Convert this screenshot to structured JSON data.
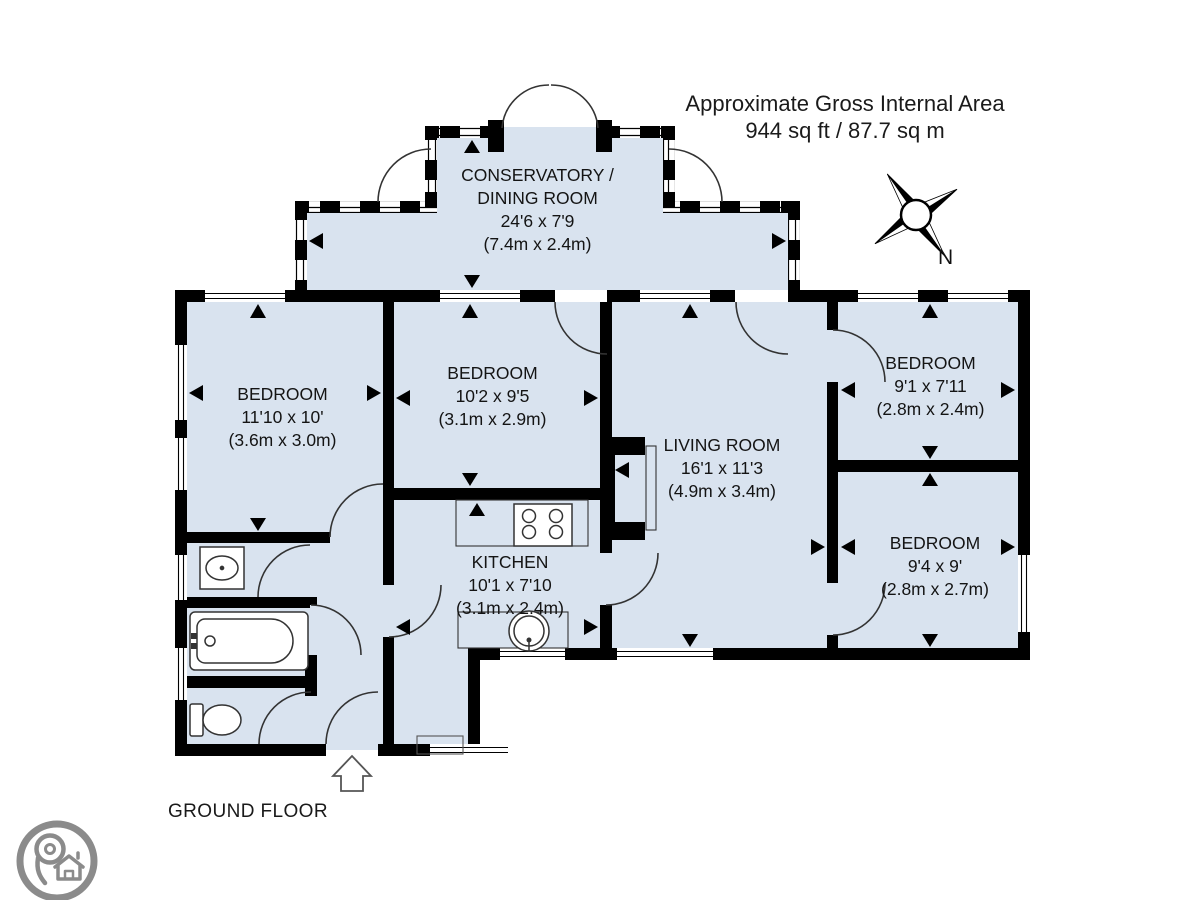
{
  "header": {
    "title_line1": "Approximate Gross Internal Area",
    "title_line2": "944 sq ft / 87.7 sq m"
  },
  "floor_label": "GROUND FLOOR",
  "compass": {
    "north_label": "N"
  },
  "rooms": [
    {
      "name": "CONSERVATORY /",
      "name2": "DINING ROOM",
      "dims_imperial": "24'6 x 7'9",
      "dims_metric": "(7.4m x 2.4m)"
    },
    {
      "name": "BEDROOM",
      "dims_imperial": "11'10 x 10'",
      "dims_metric": "(3.6m x 3.0m)"
    },
    {
      "name": "BEDROOM",
      "dims_imperial": "10'2 x 9'5",
      "dims_metric": "(3.1m x 2.9m)"
    },
    {
      "name": "BEDROOM",
      "dims_imperial": "9'1 x 7'11",
      "dims_metric": "(2.8m x 2.4m)"
    },
    {
      "name": "LIVING ROOM",
      "dims_imperial": "16'1 x 11'3",
      "dims_metric": "(4.9m x 3.4m)"
    },
    {
      "name": "BEDROOM",
      "dims_imperial": "9'4 x 9'",
      "dims_metric": "(2.8m x 2.7m)"
    },
    {
      "name": "KITCHEN",
      "dims_imperial": "10'1 x 7'10",
      "dims_metric": "(3.1m x 2.4m)"
    }
  ],
  "fixtures": [
    "bathtub",
    "toilet",
    "wash-basin",
    "hob",
    "kitchen-sink",
    "fireplace"
  ],
  "colors": {
    "room_fill": "#d9e3ef",
    "wall": "#000000",
    "detail_line": "#333333",
    "logo_gray": "#8b8b8b"
  }
}
